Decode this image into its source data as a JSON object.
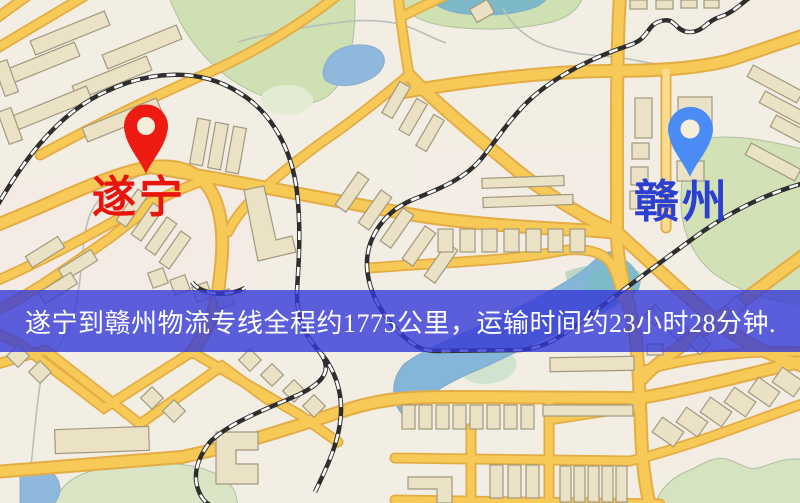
{
  "page": {
    "type": "logistics-route-map",
    "width": 800,
    "height": 503
  },
  "markers": {
    "origin": {
      "label": "遂宁",
      "pin_color": "#ee1b12",
      "pin_hole_color": "#f6eeda",
      "label_color": "#e8150d"
    },
    "destination": {
      "label": "赣州",
      "pin_color": "#4a8cf4",
      "pin_hole_color": "#f4eedb",
      "label_color": "#2b3fd0"
    }
  },
  "banner": {
    "text": "遂宁到赣州物流专线全程约1775公里，运输时间约23小时28分钟.",
    "background": "rgba(53,58,215,0.8)",
    "text_color": "#ffffff"
  },
  "map_palette": {
    "background": "#f2eee3",
    "road_fill": "#f7ca58",
    "road_casing": "#e3ac45",
    "building_fill": "#ebe2c6",
    "building_stroke": "#a1997f",
    "park_green": "#cfe0b2",
    "water_blue": "#8fb9dc",
    "railway_dark": "#2e2e2e"
  }
}
